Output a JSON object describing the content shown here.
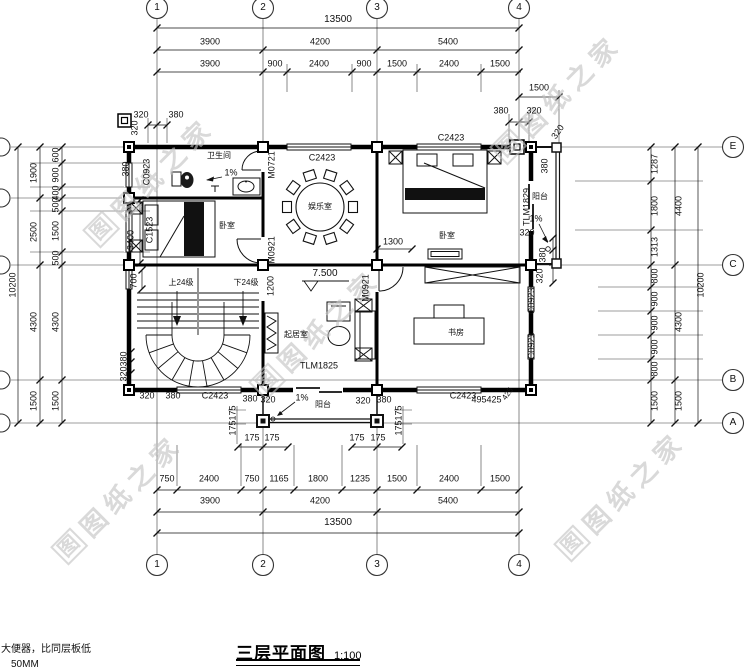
{
  "drawing": {
    "title": "三层平面图",
    "scale": "1:100",
    "notes": {
      "line1": "大便器，比同层板低",
      "line2": "50MM"
    }
  },
  "watermark": {
    "text": "图纸之家",
    "logo": "图"
  },
  "watermarks": [
    {
      "x": 150,
      "y": 180
    },
    {
      "x": 557,
      "y": 97
    },
    {
      "x": 316,
      "y": 332
    },
    {
      "x": 118,
      "y": 497
    },
    {
      "x": 621,
      "y": 494
    }
  ],
  "grid_axes": {
    "columns": [
      "1",
      "2",
      "3",
      "4"
    ],
    "rows": [
      "E",
      "C",
      "B",
      "A"
    ]
  },
  "annotations": [
    {
      "n": "dim-overall-top",
      "t": "13500",
      "x": 338,
      "y": 20,
      "fs": 10
    },
    {
      "t": "3900",
      "x": 210,
      "y": 42
    },
    {
      "t": "4200",
      "x": 320,
      "y": 42
    },
    {
      "t": "5400",
      "x": 448,
      "y": 42
    },
    {
      "t": "3900",
      "x": 210,
      "y": 64
    },
    {
      "t": "900",
      "x": 275,
      "y": 64
    },
    {
      "t": "2400",
      "x": 319,
      "y": 64
    },
    {
      "t": "900",
      "x": 364,
      "y": 64
    },
    {
      "t": "1500",
      "x": 397,
      "y": 64
    },
    {
      "t": "2400",
      "x": 449,
      "y": 64
    },
    {
      "t": "1500",
      "x": 500,
      "y": 64
    },
    {
      "t": "1500",
      "x": 539,
      "y": 88
    },
    {
      "t": "380",
      "x": 501,
      "y": 111
    },
    {
      "t": "320",
      "x": 534,
      "y": 111
    },
    {
      "t": "320",
      "x": 141,
      "y": 115
    },
    {
      "t": "380",
      "x": 176,
      "y": 115
    },
    {
      "t": "320",
      "x": 135,
      "y": 128,
      "r": -90
    },
    {
      "t": "380",
      "x": 126,
      "y": 169,
      "r": -90
    },
    {
      "t": "320",
      "x": 558,
      "y": 132,
      "r": -55
    },
    {
      "t": "380",
      "x": 545,
      "y": 166,
      "r": -90
    },
    {
      "n": "dim-overall-left",
      "t": "10200",
      "x": 13,
      "y": 285,
      "r": -90
    },
    {
      "t": "1900",
      "x": 34,
      "y": 173,
      "r": -90
    },
    {
      "t": "2500",
      "x": 34,
      "y": 232,
      "r": -90
    },
    {
      "t": "4300",
      "x": 34,
      "y": 322,
      "r": -90
    },
    {
      "t": "1500",
      "x": 34,
      "y": 401,
      "r": -90
    },
    {
      "t": "600",
      "x": 56,
      "y": 155,
      "r": -90
    },
    {
      "t": "900",
      "x": 56,
      "y": 175,
      "r": -90
    },
    {
      "t": "400",
      "x": 56,
      "y": 193,
      "r": -90
    },
    {
      "t": "500",
      "x": 56,
      "y": 205,
      "r": -90
    },
    {
      "t": "1500",
      "x": 56,
      "y": 231,
      "r": -90
    },
    {
      "t": "500",
      "x": 56,
      "y": 258,
      "r": -90
    },
    {
      "t": "4300",
      "x": 56,
      "y": 322,
      "r": -90
    },
    {
      "t": "1500",
      "x": 56,
      "y": 401,
      "r": -90
    },
    {
      "t": "3400",
      "x": 131,
      "y": 240,
      "r": -90
    },
    {
      "t": "700",
      "x": 134,
      "y": 281,
      "r": -90
    },
    {
      "t": "380",
      "x": 124,
      "y": 359,
      "r": -90
    },
    {
      "t": "320",
      "x": 124,
      "y": 374,
      "r": -90
    },
    {
      "t": "320",
      "x": 147,
      "y": 396
    },
    {
      "t": "380",
      "x": 173,
      "y": 396
    },
    {
      "t": "1287",
      "x": 655,
      "y": 164,
      "r": -90
    },
    {
      "t": "1800",
      "x": 655,
      "y": 206,
      "r": -90
    },
    {
      "t": "1313",
      "x": 655,
      "y": 247,
      "r": -90
    },
    {
      "t": "800",
      "x": 655,
      "y": 276,
      "r": -90
    },
    {
      "t": "900",
      "x": 655,
      "y": 299,
      "r": -90
    },
    {
      "t": "900",
      "x": 655,
      "y": 323,
      "r": -90
    },
    {
      "t": "900",
      "x": 655,
      "y": 347,
      "r": -90
    },
    {
      "t": "800",
      "x": 655,
      "y": 369,
      "r": -90
    },
    {
      "t": "1500",
      "x": 655,
      "y": 401,
      "r": -90
    },
    {
      "t": "4400",
      "x": 679,
      "y": 206,
      "r": -90
    },
    {
      "t": "4300",
      "x": 679,
      "y": 322,
      "r": -90
    },
    {
      "t": "1500",
      "x": 679,
      "y": 401,
      "r": -90
    },
    {
      "n": "dim-overall-right",
      "t": "10200",
      "x": 701,
      "y": 285,
      "r": -90
    },
    {
      "t": "320",
      "x": 527,
      "y": 233
    },
    {
      "t": "380",
      "x": 543,
      "y": 255,
      "r": -90
    },
    {
      "t": "320",
      "x": 540,
      "y": 276,
      "r": -90
    },
    {
      "t": "175",
      "x": 233,
      "y": 413,
      "r": -90
    },
    {
      "t": "175",
      "x": 233,
      "y": 428,
      "r": -90
    },
    {
      "t": "175",
      "x": 252,
      "y": 438
    },
    {
      "t": "175",
      "x": 272,
      "y": 438
    },
    {
      "t": "175",
      "x": 357,
      "y": 438
    },
    {
      "t": "175",
      "x": 378,
      "y": 438
    },
    {
      "t": "175",
      "x": 399,
      "y": 413,
      "r": -90
    },
    {
      "t": "175",
      "x": 399,
      "y": 428,
      "r": -90
    },
    {
      "t": "380",
      "x": 250,
      "y": 399
    },
    {
      "t": "320",
      "x": 268,
      "y": 400
    },
    {
      "n": "slope-label",
      "t": "1%",
      "x": 302,
      "y": 398
    },
    {
      "n": "room-label-balcony-south",
      "t": "阳台",
      "x": 323,
      "y": 405,
      "fs": 8
    },
    {
      "t": "320",
      "x": 363,
      "y": 401
    },
    {
      "t": "380",
      "x": 384,
      "y": 400
    },
    {
      "t": "495",
      "x": 479,
      "y": 400
    },
    {
      "t": "425",
      "x": 494,
      "y": 400
    },
    {
      "t": "425",
      "x": 508,
      "y": 394,
      "r": -55,
      "fs": 8
    },
    {
      "t": "750",
      "x": 167,
      "y": 479
    },
    {
      "t": "2400",
      "x": 209,
      "y": 479
    },
    {
      "t": "750",
      "x": 252,
      "y": 479
    },
    {
      "t": "1165",
      "x": 279,
      "y": 479
    },
    {
      "t": "1800",
      "x": 318,
      "y": 479
    },
    {
      "t": "1235",
      "x": 360,
      "y": 479
    },
    {
      "t": "1500",
      "x": 397,
      "y": 479
    },
    {
      "t": "2400",
      "x": 449,
      "y": 479
    },
    {
      "t": "1500",
      "x": 500,
      "y": 479
    },
    {
      "t": "3900",
      "x": 210,
      "y": 501
    },
    {
      "t": "4200",
      "x": 320,
      "y": 501
    },
    {
      "t": "5400",
      "x": 448,
      "y": 501
    },
    {
      "n": "dim-overall-bottom",
      "t": "13500",
      "x": 338,
      "y": 523,
      "fs": 10
    },
    {
      "t": "1300",
      "x": 393,
      "y": 242
    },
    {
      "t": "1200",
      "x": 271,
      "y": 286,
      "r": -90
    },
    {
      "n": "level-label",
      "t": "7.500",
      "x": 325,
      "y": 274,
      "fs": 10
    },
    {
      "n": "slope-label",
      "t": "1%",
      "x": 231,
      "y": 173
    },
    {
      "n": "slope-label",
      "t": "1%",
      "x": 536,
      "y": 219
    },
    {
      "n": "room-label-bathroom",
      "t": "卫生间",
      "x": 219,
      "y": 156,
      "fs": 8
    },
    {
      "n": "room-label-recreation",
      "t": "娱乐室",
      "x": 320,
      "y": 207,
      "fs": 8
    },
    {
      "n": "room-label-bedroom-west",
      "t": "卧室",
      "x": 227,
      "y": 226,
      "fs": 8
    },
    {
      "n": "room-label-bedroom-east",
      "t": "卧室",
      "x": 447,
      "y": 236,
      "fs": 8
    },
    {
      "n": "room-label-living",
      "t": "起居室",
      "x": 296,
      "y": 335,
      "fs": 8
    },
    {
      "n": "room-label-study",
      "t": "书房",
      "x": 456,
      "y": 333,
      "fs": 8
    },
    {
      "n": "room-label-balcony-east",
      "t": "阳台",
      "x": 540,
      "y": 197,
      "fs": 8
    },
    {
      "n": "stair-up-label",
      "t": "上24级",
      "x": 181,
      "y": 283,
      "fs": 8
    },
    {
      "n": "stair-down-label",
      "t": "下24级",
      "x": 246,
      "y": 283,
      "fs": 8
    },
    {
      "n": "window-tag",
      "t": "C2423",
      "x": 322,
      "y": 158
    },
    {
      "n": "window-tag",
      "t": "C2423",
      "x": 451,
      "y": 138
    },
    {
      "n": "window-tag",
      "t": "C2423",
      "x": 215,
      "y": 396
    },
    {
      "n": "window-tag",
      "t": "C2423",
      "x": 463,
      "y": 396
    },
    {
      "n": "window-tag",
      "t": "C0923",
      "x": 147,
      "y": 172,
      "r": -90
    },
    {
      "n": "window-tag",
      "t": "C1523",
      "x": 150,
      "y": 230,
      "r": -90
    },
    {
      "n": "window-tag",
      "t": "C0923",
      "x": 532,
      "y": 301,
      "r": -90
    },
    {
      "n": "window-tag",
      "t": "C0923",
      "x": 532,
      "y": 346,
      "r": -90
    },
    {
      "n": "door-tag",
      "t": "M0721",
      "x": 272,
      "y": 165,
      "r": -90
    },
    {
      "n": "door-tag",
      "t": "M0921",
      "x": 272,
      "y": 250,
      "r": -90
    },
    {
      "n": "door-tag",
      "t": "M0921",
      "x": 366,
      "y": 288,
      "r": -90
    },
    {
      "n": "door-tag",
      "t": "TLM1829",
      "x": 527,
      "y": 207,
      "r": -90
    },
    {
      "n": "door-tag",
      "t": "TLM1825",
      "x": 319,
      "y": 366
    },
    {
      "n": "grid-bubble-label",
      "t": "1",
      "x": 157,
      "y": 8,
      "fs": 10
    },
    {
      "n": "grid-bubble-label",
      "t": "2",
      "x": 263,
      "y": 8,
      "fs": 10
    },
    {
      "n": "grid-bubble-label",
      "t": "3",
      "x": 377,
      "y": 8,
      "fs": 10
    },
    {
      "n": "grid-bubble-label",
      "t": "4",
      "x": 519,
      "y": 8,
      "fs": 10
    },
    {
      "n": "grid-bubble-label",
      "t": "1",
      "x": 157,
      "y": 565,
      "fs": 10
    },
    {
      "n": "grid-bubble-label",
      "t": "2",
      "x": 263,
      "y": 565,
      "fs": 10
    },
    {
      "n": "grid-bubble-label",
      "t": "3",
      "x": 377,
      "y": 565,
      "fs": 10
    },
    {
      "n": "grid-bubble-label",
      "t": "4",
      "x": 519,
      "y": 565,
      "fs": 10
    },
    {
      "n": "grid-bubble-label",
      "t": "E",
      "x": 733,
      "y": 147,
      "fs": 10
    },
    {
      "n": "grid-bubble-label",
      "t": "C",
      "x": 733,
      "y": 265,
      "fs": 10
    },
    {
      "n": "grid-bubble-label",
      "t": "B",
      "x": 733,
      "y": 380,
      "fs": 10
    },
    {
      "n": "grid-bubble-label",
      "t": "A",
      "x": 733,
      "y": 423,
      "fs": 10
    }
  ]
}
